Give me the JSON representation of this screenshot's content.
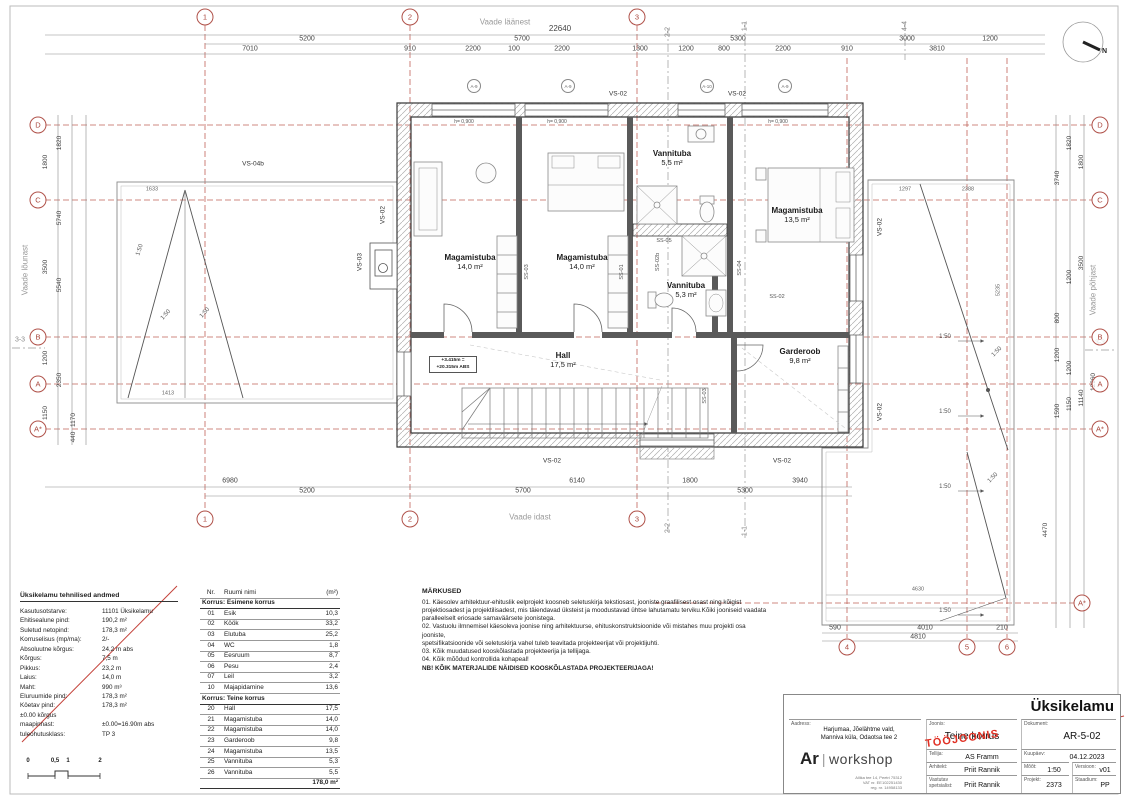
{
  "sheet": {
    "title": "Üksikelamu"
  },
  "colors": {
    "grid_red": "#b0524a",
    "stamp_red": "#e03024",
    "wall": "#3a3a3a"
  },
  "compass": {
    "label": "N"
  },
  "views": {
    "west": "Vaade läänest",
    "east": "Vaade idast",
    "south": "Vaade lõunast",
    "north": "Vaade põhjast"
  },
  "grid": {
    "c1": "1",
    "c2": "2",
    "c3": "3",
    "c4": "4",
    "c5": "5",
    "c6": "6",
    "rD": "D",
    "rC": "C",
    "rB": "B",
    "rA": "A",
    "rAs": "A*"
  },
  "sections": {
    "s11": "1-1",
    "s22": "2-2",
    "s33": "3-3",
    "s44": "4-4"
  },
  "dims": {
    "top_total": "22640",
    "t2": [
      "5200",
      "5700",
      "5300",
      "3000",
      "1200"
    ],
    "t3": [
      "7010",
      "910",
      "2200",
      "100",
      "2200",
      "1300",
      "1200",
      "800",
      "2200",
      "910",
      "3810"
    ],
    "b1": [
      "6980",
      "6140",
      "1800",
      "3940"
    ],
    "b2": [
      "5200",
      "5700",
      "5300"
    ],
    "left": [
      "1820",
      "1800",
      "5740",
      "3500",
      "5540",
      "1200",
      "2350",
      "1150",
      "1170",
      "440"
    ],
    "right": [
      "1820",
      "1800",
      "3740",
      "3500",
      "1200",
      "800",
      "1200",
      "1200",
      "12960",
      "11140",
      "1150",
      "1590"
    ],
    "roof": {
      "d590": "590",
      "d4010": "4010",
      "d210": "210",
      "d4810": "4810",
      "d4470": "4470",
      "d4630": "4630",
      "d5235": "5235",
      "d1297": "1297",
      "d2388": "2388"
    },
    "lroof": {
      "d1633": "1633",
      "d1413": "1413"
    }
  },
  "plan": {
    "rooms": {
      "bed1": {
        "name": "Magamistuba",
        "area": "14,0 m²"
      },
      "bed2": {
        "name": "Magamistuba",
        "area": "14,0 m²"
      },
      "bath1": {
        "name": "Vannituba",
        "area": "5,5 m²"
      },
      "bath2": {
        "name": "Vannituba",
        "area": "5,3 m²"
      },
      "bed3": {
        "name": "Magamistuba",
        "area": "13,5 m²"
      },
      "hall": {
        "name": "Hall",
        "area": "17,5 m²"
      },
      "gard": {
        "name": "Garderoob",
        "area": "9,8 m²"
      }
    },
    "elev": {
      "l1": "+3.415m =",
      "l2": "+20.315m ABS"
    },
    "labels": {
      "vs02": "VS-02",
      "vs03": "VS-03",
      "vs04b": "VS-04b",
      "ss01": "SS-01",
      "ss02": "SS-02",
      "ss02b": "SS-02b",
      "ss03": "SS-03",
      "ss04": "SS-04",
      "ss05": "SS-05"
    },
    "win_h": "h= 0,900",
    "slope": "1:50",
    "tags": {
      "a9": "A-9",
      "a10": "A-10"
    }
  },
  "tech": {
    "title": "Üksikelamu tehnilised andmed",
    "rows": [
      {
        "label": "Kasutusotstarve:",
        "value": "11101 Üksikelamu"
      },
      {
        "label": "Ehitisealune pind:",
        "value": "190,2 m²"
      },
      {
        "label": "Suletud netopind:",
        "value": "178,3 m²"
      },
      {
        "label": "Korruselisus (mp/ma):",
        "value": "2/-"
      },
      {
        "label": "Absoluutne kõrgus:",
        "value": "24,2 m abs"
      },
      {
        "label": "Kõrgus:",
        "value": "7,5 m"
      },
      {
        "label": "Pikkus:",
        "value": "23,2 m"
      },
      {
        "label": "Laius:",
        "value": "14,0 m"
      },
      {
        "label": "Maht:",
        "value": "990 m³"
      },
      {
        "label": "Eluruumide pind:",
        "value": "178,3 m²"
      },
      {
        "label": "Köetav pind:",
        "value": "178,3 m²"
      },
      {
        "label": "±0.00 kõrgus",
        "value": ""
      },
      {
        "label": "maapinnast:",
        "value": "±0.00=16.90m abs"
      },
      {
        "label": "tuleohutusklass:",
        "value": "TP 3"
      }
    ]
  },
  "scalebar": {
    "t0": "0",
    "t05": "0,5",
    "t1": "1",
    "t2": "2"
  },
  "room_table": {
    "h_nr": "Nr.",
    "h_name": "Ruumi nimi",
    "h_area": "(m²)",
    "sec1": "Korrus:  Esimene korrus",
    "floor1": [
      {
        "nr": "01",
        "name": "Esik",
        "area": "10,3"
      },
      {
        "nr": "02",
        "name": "Köök",
        "area": "33,2"
      },
      {
        "nr": "03",
        "name": "Elutuba",
        "area": "25,2"
      },
      {
        "nr": "04",
        "name": "WC",
        "area": "1,8"
      },
      {
        "nr": "05",
        "name": "Eesruum",
        "area": "8,7"
      },
      {
        "nr": "06",
        "name": "Pesu",
        "area": "2,4"
      },
      {
        "nr": "07",
        "name": "Leil",
        "area": "3,2"
      },
      {
        "nr": "10",
        "name": "Majapidamine",
        "area": "13,6"
      }
    ],
    "sec2": "Korrus:  Teine korrus",
    "floor2": [
      {
        "nr": "20",
        "name": "Hall",
        "area": "17,5"
      },
      {
        "nr": "21",
        "name": "Magamistuba",
        "area": "14,0"
      },
      {
        "nr": "22",
        "name": "Magamistuba",
        "area": "14,0"
      },
      {
        "nr": "23",
        "name": "Garderoob",
        "area": "9,8"
      },
      {
        "nr": "24",
        "name": "Magamistuba",
        "area": "13,5"
      },
      {
        "nr": "25",
        "name": "Vannituba",
        "area": "5,3"
      },
      {
        "nr": "26",
        "name": "Vannituba",
        "area": "5,5"
      }
    ],
    "total": "178,0 m²"
  },
  "notes": {
    "title": "MÄRKUSED",
    "lines": [
      "01. Käesolev arhitektuur-ehituslik eelprojekt koosneb seletuskirja tekstiosast, jooniste graafilisest osast ning kõigist",
      "projektiosadest ja projektilisadest, mis täiendavad üksteist ja moodustavad ühtse lahutamatu terviku.Kõiki jooniseid vaadata",
      "paralleelselt eriosade samaväärsete joonistega.",
      "02. Vastuolu ilmnemisel käesoleva joonise ning arhitektuurse, ehituskonstruktsioonide või mistahes muu projekti osa jooniste,",
      "spetsifikatsioonide või seletuskirja vahel tuleb teavitada projekteerijat või projektijuhti.",
      "03. Kõik muudatused kooskõlastada projekteerija ja tellijaga.",
      "04. Kõik mõõdud kontrollida kohapeal!"
    ],
    "nb": "NB! KÕIK MATERJALIDE NÄIDISED KOOSKÕLASTADA PROJEKTEERIJAGA!"
  },
  "titleblock": {
    "project_title": "Üksikelamu",
    "stamp": "TÖÖJOONIS",
    "logo_ar": "Ar",
    "logo_sep": "|",
    "logo_workshop": "workshop",
    "logo_line1": "Allika tee 14, Peetri 75312",
    "logo_line2": "VAT nr. EE102251430",
    "logo_line3": "reg. nr. 14958133",
    "aadress_label": "Aadress:",
    "aadress_value1": "Harjumaa, Jõelähtme vald,",
    "aadress_value2": "Manniva küla, Odaotsa tee 2",
    "joonis_label": "Joonis:",
    "joonis_value": "Teine korrus",
    "dokument_label": "Dokument:",
    "dokument_value": "AR-5-02",
    "tellija_label": "Tellija:",
    "tellija_value": "AS Framm",
    "kuupaev_label": "Kuupäev:",
    "kuupaev_value": "04.12.2023",
    "arhitekt_label": "Arhitekt:",
    "arhitekt_value": "Priit Rannik",
    "moot_label": "Mõõt:",
    "moot_value": "1:50",
    "versioon_label": "Versioon:",
    "versioon_value": "v01",
    "vastutav_label1": "Vastutav",
    "vastutav_label2": "spetsialist:",
    "vastutav_value": "Priit Rannik",
    "projekt_label": "Projekt:",
    "projekt_value": "2373",
    "staadium_label": "Staadium:",
    "staadium_value": "PP"
  }
}
